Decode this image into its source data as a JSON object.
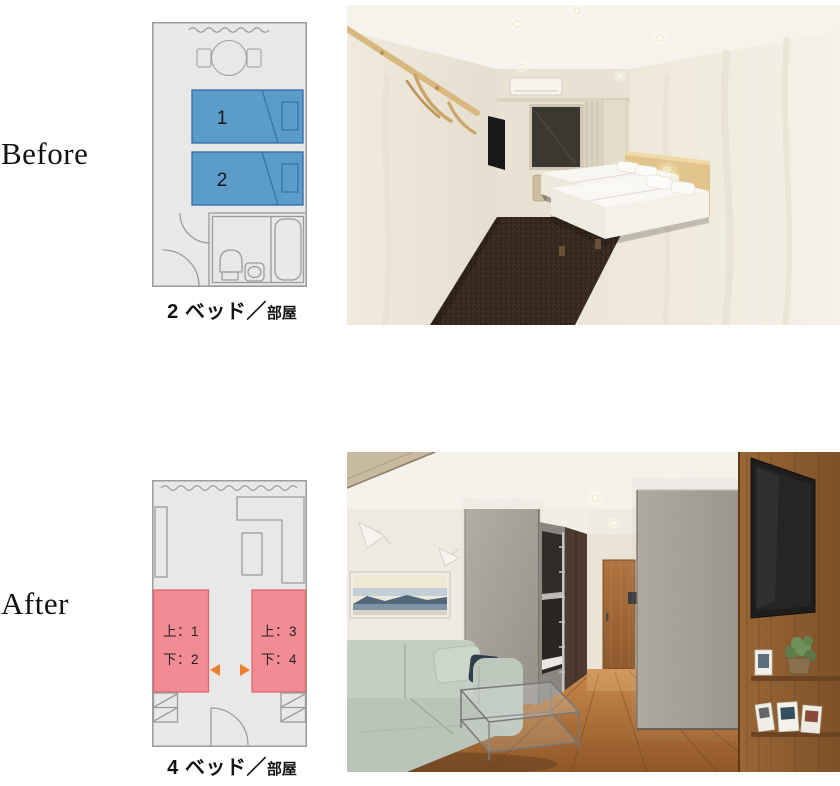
{
  "before": {
    "label": "Before",
    "plan": {
      "beds": [
        {
          "number": "1"
        },
        {
          "number": "2"
        }
      ],
      "caption": {
        "main": "2 ベッド",
        "separator": "／",
        "sub": "部屋"
      }
    }
  },
  "after": {
    "label": "After",
    "plan": {
      "beds": [
        {
          "upper": "上：1",
          "lower": "下：2"
        },
        {
          "upper": "上：3",
          "lower": "下：4"
        }
      ],
      "caption": {
        "main": "4 ベッド",
        "separator": "／",
        "sub": "部屋"
      }
    }
  },
  "colors": {
    "plan_room_fill": "#E8E8E8",
    "plan_line": "#9C9C9C",
    "bed_blue_fill": "#5C9CCB",
    "bed_blue_border": "#2F6DA8",
    "bed_pink_fill": "#F18D92",
    "bed_pink_border": "#E0676E",
    "arrow_orange": "#EE7D2E",
    "label_text": "#121212"
  }
}
